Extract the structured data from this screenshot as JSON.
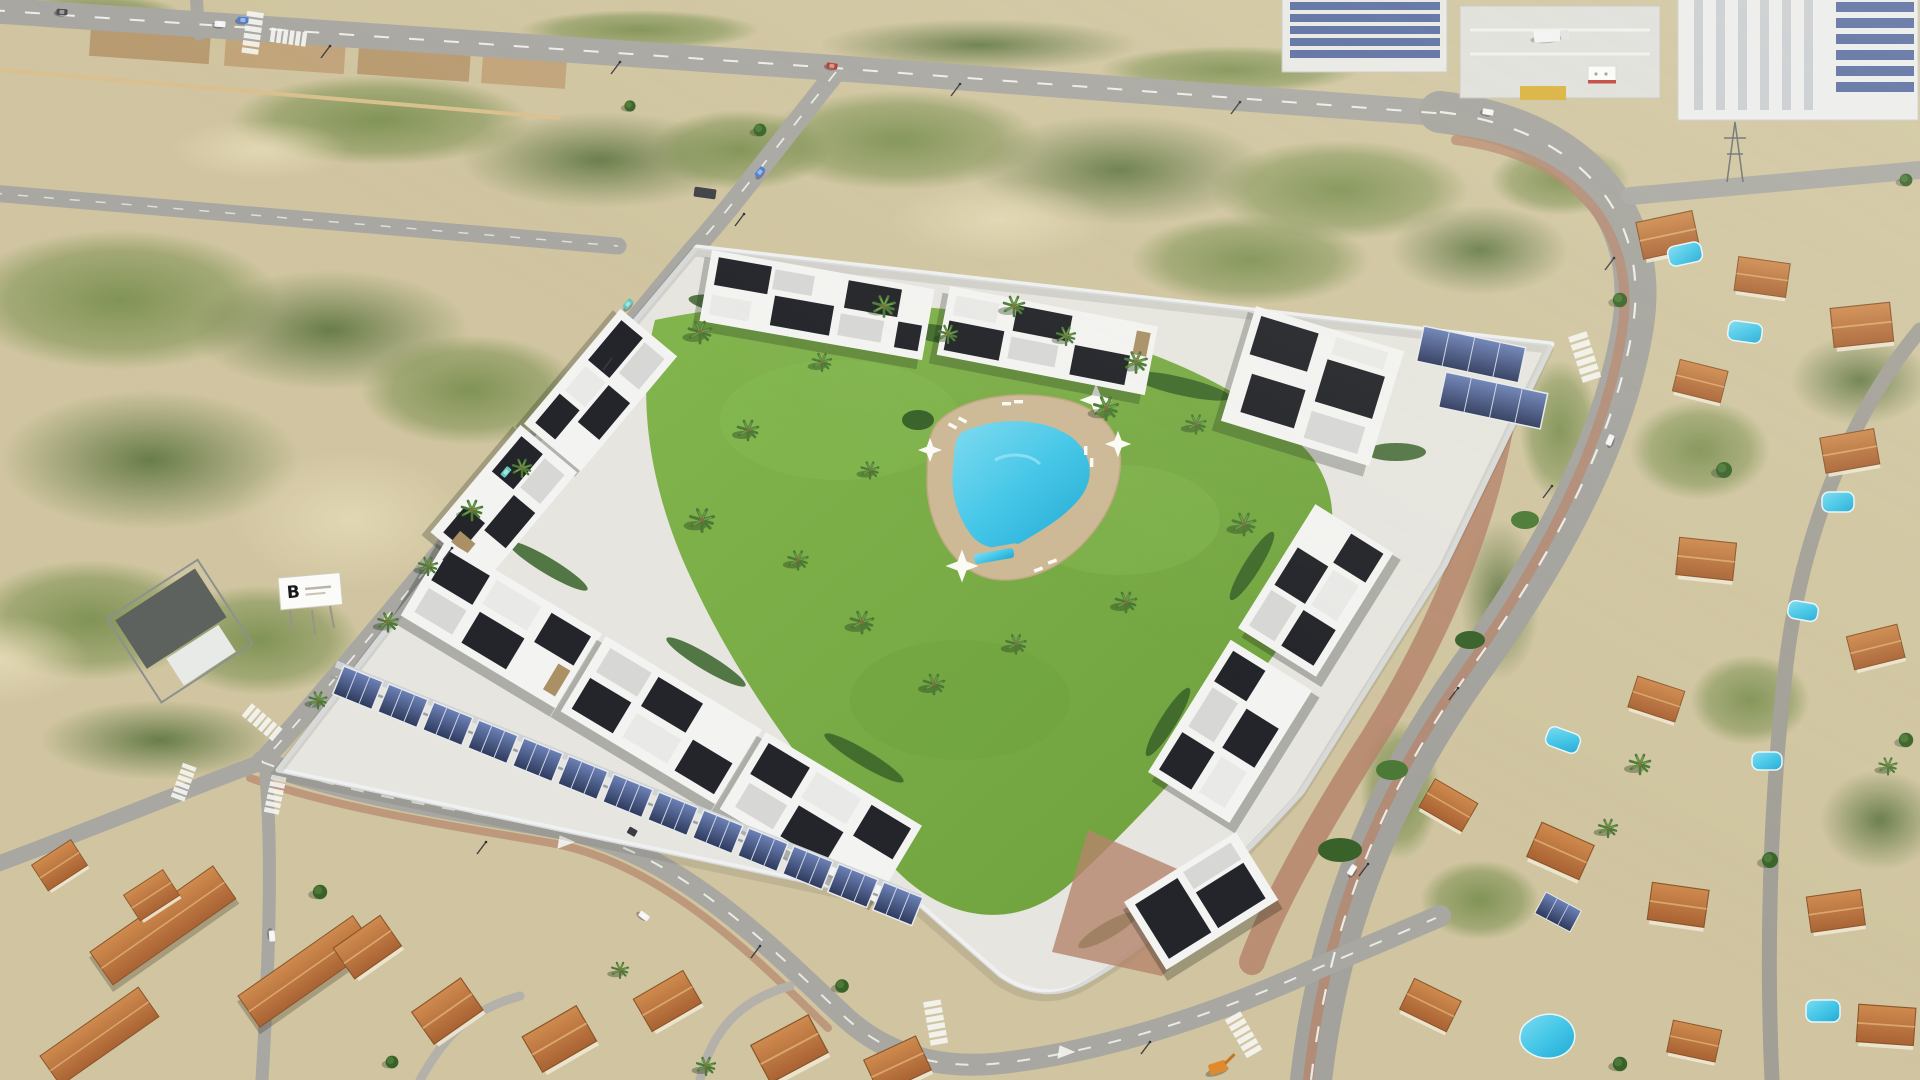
{
  "meta": {
    "type": "aerial-photo"
  },
  "scene": {
    "description": "Aerial 3D render of a new Mediterranean residential development: white and black modern townhouses arranged around a central lawn with an L-shaped swimming pool, palm trees, solar-panel carports along the perimeter wall, vacant scrubland parcels to the north-west, a curving highway to the east, industrial warehouses at the top right, and existing terracotta-roofed villas with private pools at the bottom and right."
  },
  "billboard": {
    "label": "B"
  },
  "colors": {
    "sand": "#d0c5a0",
    "sand_light": "#ddd2ae",
    "scrub_green": "#7d9152",
    "scrub_dark": "#607a41",
    "dirt": "#b99b71",
    "tan_wall": "#d9c08e",
    "road": "#a8a7a2",
    "road_dark": "#999893",
    "marking": "#f5f5f2",
    "sidewalk_red": "#b5846b",
    "lawn": "#77ab43",
    "lawn_light": "#8abc55",
    "pool_blue": "#45c7e8",
    "pool_deep": "#22a9d4",
    "deck_tan": "#cdb996",
    "bldg_white": "#f3f3f1",
    "bldg_black": "#23252a",
    "bldg_gray": "#d7d8d6",
    "stone": "#ab9065",
    "wall_white": "#eef0f1",
    "solar_dark": "#2e3a5c",
    "solar_blue": "#52679e",
    "terracotta": "#b8703c",
    "terracotta_light": "#cf8a4e",
    "roof_ridge": "#8a5529",
    "tree_green": "#4c7a36",
    "tree_dark": "#39622a",
    "car_white": "#f2f3f4",
    "car_teal": "#5fc9c4",
    "car_blue": "#4a7fd6",
    "car_red": "#b03a30",
    "car_dark": "#4a4d52",
    "machine_orange": "#e08a2e"
  }
}
